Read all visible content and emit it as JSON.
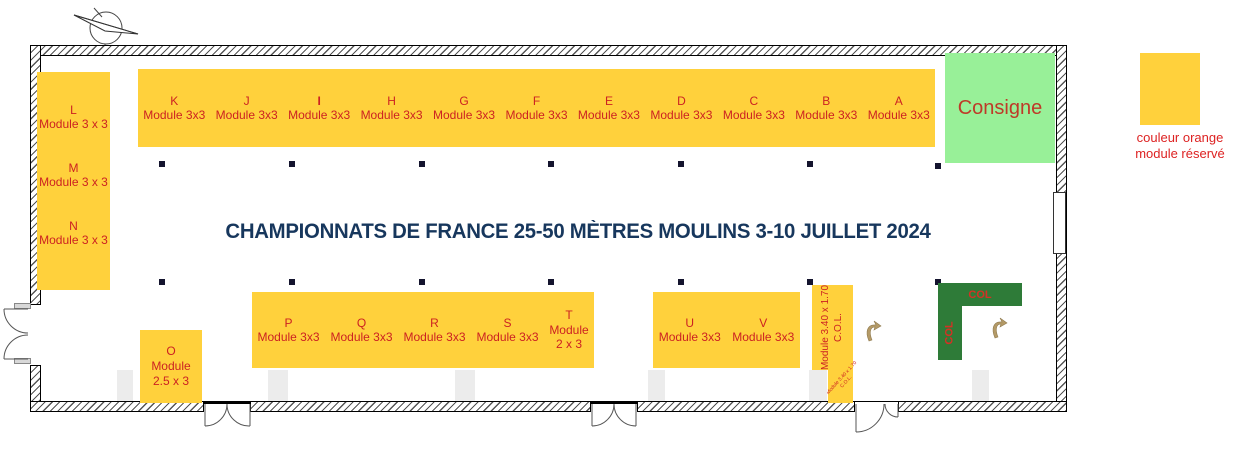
{
  "title": "CHAMPIONNATS DE FRANCE 25-50 MÈTRES MOULINS 3-10 JUILLET 2024",
  "consigne": {
    "label": "Consigne"
  },
  "legend": {
    "line1": "couleur orange",
    "line2": "module réservé"
  },
  "col_area": {
    "horizontal_label": "COL",
    "vertical_label": "COL"
  },
  "left_modules": [
    {
      "letter": "L",
      "size": "Module 3 x 3"
    },
    {
      "letter": "M",
      "size": "Module 3 x 3"
    },
    {
      "letter": "N",
      "size": "Module 3 x 3"
    }
  ],
  "top_modules": [
    {
      "letter": "K",
      "size": "Module 3x3"
    },
    {
      "letter": "J",
      "size": "Module 3x3"
    },
    {
      "letter": "I",
      "size": "Module 3x3"
    },
    {
      "letter": "H",
      "size": "Module 3x3"
    },
    {
      "letter": "G",
      "size": "Module 3x3"
    },
    {
      "letter": "F",
      "size": "Module 3x3"
    },
    {
      "letter": "E",
      "size": "Module 3x3"
    },
    {
      "letter": "D",
      "size": "Module 3x3"
    },
    {
      "letter": "C",
      "size": "Module 3x3"
    },
    {
      "letter": "B",
      "size": "Module 3x3"
    },
    {
      "letter": "A",
      "size": "Module 3x3"
    }
  ],
  "bottom_modules": [
    {
      "letter": "P",
      "size": "Module 3x3"
    },
    {
      "letter": "Q",
      "size": "Module 3x3"
    },
    {
      "letter": "R",
      "size": "Module 3x3"
    },
    {
      "letter": "S",
      "size": "Module 3x3"
    },
    {
      "letter": "T",
      "size_line1": "Module",
      "size_line2": "2 x 3"
    }
  ],
  "uv_modules": [
    {
      "letter": "U",
      "size": "Module 3x3"
    },
    {
      "letter": "V",
      "size": "Module 3x3"
    }
  ],
  "o_module": {
    "letter": "O",
    "size_line1": "Module",
    "size_line2": "2.5 x 3"
  },
  "col_module": {
    "line1": "Module 3.40 x 1.70",
    "line2": "C.O.L."
  },
  "col_module_footnote": {
    "line1": "Module 3.40 x 1.70",
    "line2": "C.O.L."
  },
  "colors": {
    "module_fill": "#FFD13C",
    "module_text": "#CC2222",
    "title_text": "#17375D",
    "consigne_fill": "#98F098",
    "col_fill": "#2E7B38"
  }
}
